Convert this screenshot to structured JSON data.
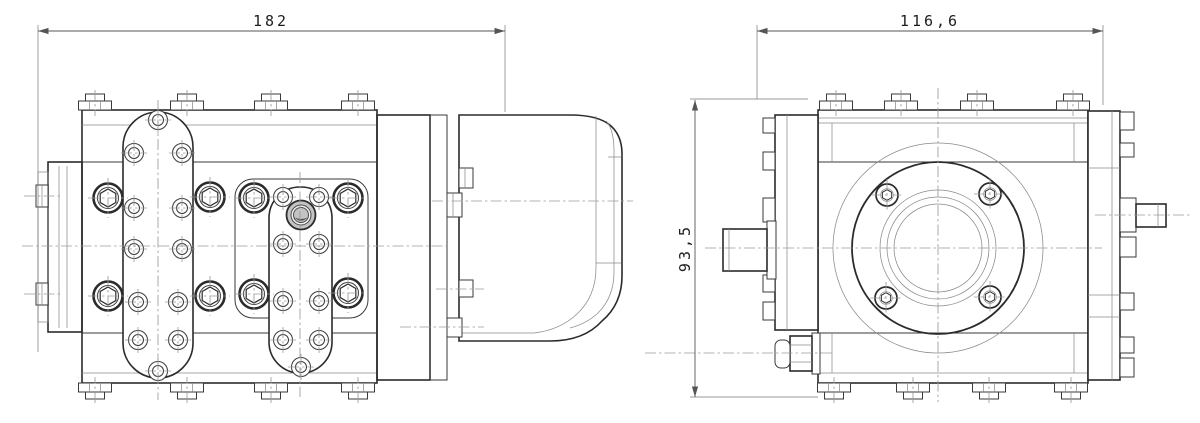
{
  "drawing": {
    "background": "#ffffff",
    "line_color": "#2b2b2b",
    "thin_line_color": "#8a8a8a",
    "centerline_color": "#9a9a9a",
    "highlight_fill": "#c3c3c3",
    "dimensions": [
      {
        "name": "overall-length-side-view",
        "label": "182",
        "orientation": "horizontal"
      },
      {
        "name": "overall-width-front-view",
        "label": "116,6",
        "orientation": "horizontal"
      },
      {
        "name": "overall-height-front-view",
        "label": "93,5",
        "orientation": "vertical"
      }
    ],
    "views": [
      {
        "name": "side-view",
        "description": "Side elevation: housing with two stadium-shaped mounting plates, socket-head screws, hex-socket bolts, end cover and rounded rear housing"
      },
      {
        "name": "front-view",
        "description": "Front elevation: square housing with circular bearing flange, four flange screws, drive shaft, side ports and plugs"
      }
    ]
  }
}
